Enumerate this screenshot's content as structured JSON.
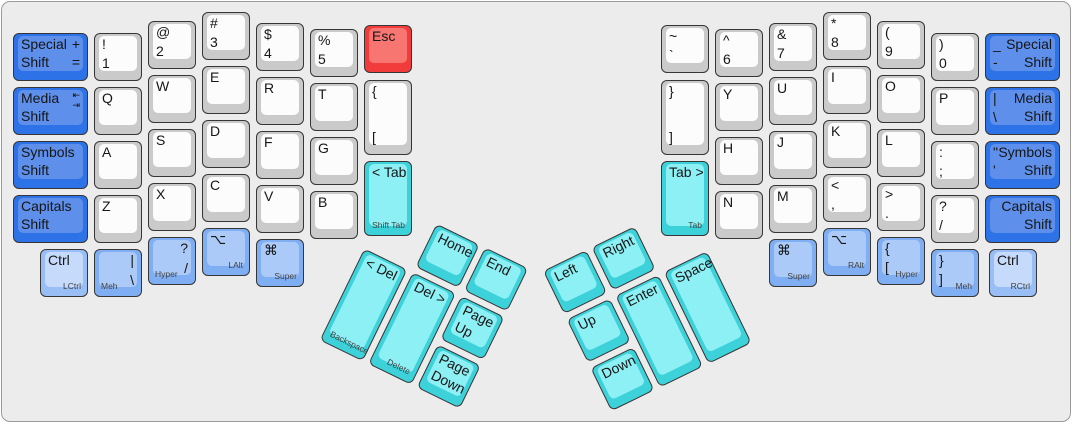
{
  "panel": {
    "background": "#ececec",
    "border": "#9b9b9b"
  },
  "colors": {
    "white": {
      "base": "#cacaca",
      "top": "#fcfcfc"
    },
    "blue": {
      "base": "#2d72e6",
      "top": "#5d8feb"
    },
    "lblue": {
      "base": "#80aef3",
      "top": "#abcaf8"
    },
    "ctrl": {
      "base": "#98bef5",
      "top": "#c6dbfb"
    },
    "cyan": {
      "base": "#3dd1d9",
      "top": "#8df0f4"
    },
    "red": {
      "base": "#f23c3c",
      "top": "#f87672"
    }
  },
  "clusters": {
    "left": {
      "x": 386,
      "y": 198,
      "angle": 26,
      "group": "lt"
    },
    "right": {
      "x": 541,
      "y": 269,
      "angle": -26,
      "group": "rt"
    }
  },
  "keys": [
    {
      "n": "special-shift-left",
      "x": 11,
      "y": 31,
      "w": 75,
      "c": "blue",
      "tl": [
        "Special",
        "Shift"
      ],
      "tr": [
        "+",
        "="
      ]
    },
    {
      "n": "media-shift-left",
      "x": 11,
      "y": 85,
      "w": 75,
      "c": "blue",
      "tl": [
        "Media",
        "Shift"
      ],
      "tr": [
        "⇤",
        "⇥"
      ],
      "tiny": true
    },
    {
      "n": "symbols-shift-left",
      "x": 11,
      "y": 139,
      "w": 75,
      "c": "blue",
      "tl": [
        "Symbols",
        "Shift"
      ]
    },
    {
      "n": "capitals-shift-left",
      "x": 11,
      "y": 193,
      "w": 75,
      "c": "blue",
      "tl": [
        "Capitals",
        "Shift"
      ]
    },
    {
      "n": "key-1",
      "x": 92,
      "y": 31,
      "tl": [
        "!"
      ],
      "bl": [
        "1"
      ]
    },
    {
      "n": "key-q",
      "x": 92,
      "y": 85,
      "tl": [
        "Q"
      ]
    },
    {
      "n": "key-a",
      "x": 92,
      "y": 139,
      "tl": [
        "A"
      ]
    },
    {
      "n": "key-z",
      "x": 92,
      "y": 193,
      "tl": [
        "Z"
      ]
    },
    {
      "n": "meh-left",
      "x": 92,
      "y": 247,
      "c": "lblue",
      "tr": [
        "|"
      ],
      "br": [
        "\\"
      ],
      "subl": "Meh"
    },
    {
      "n": "key-2",
      "x": 146,
      "y": 19,
      "tl": [
        "@"
      ],
      "bl": [
        "2"
      ]
    },
    {
      "n": "key-w",
      "x": 146,
      "y": 73,
      "tl": [
        "W"
      ]
    },
    {
      "n": "key-s",
      "x": 146,
      "y": 127,
      "tl": [
        "S"
      ]
    },
    {
      "n": "key-x",
      "x": 146,
      "y": 181,
      "tl": [
        "X"
      ]
    },
    {
      "n": "hyper-left",
      "x": 146,
      "y": 235,
      "c": "lblue",
      "tr": [
        "?"
      ],
      "br": [
        "/"
      ],
      "subl": "Hyper"
    },
    {
      "n": "key-3",
      "x": 200,
      "y": 10,
      "tl": [
        "#"
      ],
      "bl": [
        "3"
      ]
    },
    {
      "n": "key-e",
      "x": 200,
      "y": 64,
      "tl": [
        "E"
      ]
    },
    {
      "n": "key-d",
      "x": 200,
      "y": 118,
      "tl": [
        "D"
      ]
    },
    {
      "n": "key-c",
      "x": 200,
      "y": 172,
      "tl": [
        "C"
      ]
    },
    {
      "n": "lalt",
      "x": 200,
      "y": 226,
      "c": "lblue",
      "tl": [
        "⌥"
      ],
      "sub": "LAlt"
    },
    {
      "n": "key-4",
      "x": 254,
      "y": 21,
      "tl": [
        "$"
      ],
      "bl": [
        "4"
      ]
    },
    {
      "n": "key-r",
      "x": 254,
      "y": 75,
      "tl": [
        "R"
      ]
    },
    {
      "n": "key-f",
      "x": 254,
      "y": 129,
      "tl": [
        "F"
      ]
    },
    {
      "n": "key-v",
      "x": 254,
      "y": 183,
      "tl": [
        "V"
      ]
    },
    {
      "n": "super-left",
      "x": 254,
      "y": 237,
      "c": "lblue",
      "tl": [
        "⌘"
      ],
      "sub": "Super"
    },
    {
      "n": "key-5",
      "x": 308,
      "y": 27,
      "tl": [
        "%"
      ],
      "bl": [
        "5"
      ]
    },
    {
      "n": "key-t",
      "x": 308,
      "y": 81,
      "tl": [
        "T"
      ]
    },
    {
      "n": "key-g",
      "x": 308,
      "y": 135,
      "tl": [
        "G"
      ]
    },
    {
      "n": "key-b",
      "x": 308,
      "y": 189,
      "tl": [
        "B"
      ]
    },
    {
      "n": "esc-key",
      "x": 362,
      "y": 23,
      "c": "red",
      "tl": [
        "Esc"
      ]
    },
    {
      "n": "lbrace-key",
      "x": 362,
      "y": 78,
      "h": 75,
      "tl": [
        "{"
      ],
      "bl": [
        "["
      ]
    },
    {
      "n": "tab-left",
      "x": 362,
      "y": 159,
      "h": 75,
      "c": "cyan",
      "tl": [
        "< Tab"
      ],
      "sub": "Shift Tab"
    },
    {
      "n": "ctrl-left",
      "x": 38,
      "y": 247,
      "c": "ctrl",
      "tl": [
        "Ctrl"
      ],
      "sub": "LCtrl"
    },
    {
      "n": "key-tilde",
      "x": 659,
      "y": 23,
      "tl": [
        "~"
      ],
      "bl": [
        "`"
      ]
    },
    {
      "n": "rbrace-key",
      "x": 659,
      "y": 78,
      "h": 75,
      "tl": [
        "}"
      ],
      "bl": [
        "]"
      ]
    },
    {
      "n": "tab-right",
      "x": 659,
      "y": 159,
      "h": 75,
      "c": "cyan",
      "tl": [
        "Tab >"
      ],
      "sub": "Tab"
    },
    {
      "n": "key-6",
      "x": 713,
      "y": 27,
      "tl": [
        "^"
      ],
      "bl": [
        "6"
      ]
    },
    {
      "n": "key-y",
      "x": 713,
      "y": 81,
      "tl": [
        "Y"
      ]
    },
    {
      "n": "key-h",
      "x": 713,
      "y": 135,
      "tl": [
        "H"
      ]
    },
    {
      "n": "key-n",
      "x": 713,
      "y": 189,
      "tl": [
        "N"
      ]
    },
    {
      "n": "key-7",
      "x": 767,
      "y": 21,
      "tl": [
        "&"
      ],
      "bl": [
        "7"
      ]
    },
    {
      "n": "key-u",
      "x": 767,
      "y": 75,
      "tl": [
        "U"
      ]
    },
    {
      "n": "key-j",
      "x": 767,
      "y": 129,
      "tl": [
        "J"
      ]
    },
    {
      "n": "key-m",
      "x": 767,
      "y": 183,
      "tl": [
        "M"
      ]
    },
    {
      "n": "super-right",
      "x": 767,
      "y": 237,
      "c": "lblue",
      "tl": [
        "⌘"
      ],
      "sub": "Super"
    },
    {
      "n": "key-8",
      "x": 821,
      "y": 10,
      "tl": [
        "*"
      ],
      "bl": [
        "8"
      ]
    },
    {
      "n": "key-i",
      "x": 821,
      "y": 64,
      "tl": [
        "I"
      ]
    },
    {
      "n": "key-k",
      "x": 821,
      "y": 118,
      "tl": [
        "K"
      ]
    },
    {
      "n": "key-comma",
      "x": 821,
      "y": 172,
      "tl": [
        "<"
      ],
      "bl": [
        ","
      ]
    },
    {
      "n": "ralt",
      "x": 821,
      "y": 226,
      "c": "lblue",
      "tl": [
        "⌥"
      ],
      "sub": "RAlt"
    },
    {
      "n": "key-9",
      "x": 875,
      "y": 19,
      "tl": [
        "("
      ],
      "bl": [
        "9"
      ]
    },
    {
      "n": "key-o",
      "x": 875,
      "y": 73,
      "tl": [
        "O"
      ]
    },
    {
      "n": "key-l",
      "x": 875,
      "y": 127,
      "tl": [
        "L"
      ]
    },
    {
      "n": "key-period",
      "x": 875,
      "y": 181,
      "tl": [
        ">"
      ],
      "bl": [
        "."
      ]
    },
    {
      "n": "hyper-right",
      "x": 875,
      "y": 235,
      "c": "lblue",
      "tl": [
        "{"
      ],
      "bl": [
        "["
      ],
      "sub": "Hyper"
    },
    {
      "n": "key-0",
      "x": 929,
      "y": 31,
      "tl": [
        ")"
      ],
      "bl": [
        "0"
      ]
    },
    {
      "n": "key-p",
      "x": 929,
      "y": 85,
      "tl": [
        "P"
      ]
    },
    {
      "n": "key-semicolon",
      "x": 929,
      "y": 139,
      "tl": [
        ":"
      ],
      "bl": [
        ";"
      ]
    },
    {
      "n": "key-slash",
      "x": 929,
      "y": 193,
      "tl": [
        "?"
      ],
      "bl": [
        "/"
      ]
    },
    {
      "n": "meh-right",
      "x": 929,
      "y": 247,
      "c": "lblue",
      "tl": [
        "}"
      ],
      "bl": [
        "]"
      ],
      "sub": "Meh"
    },
    {
      "n": "special-shift-right",
      "x": 983,
      "y": 31,
      "w": 75,
      "c": "blue",
      "tr": [
        "Special",
        "Shift"
      ],
      "tl": [
        "_",
        "-"
      ]
    },
    {
      "n": "media-shift-right",
      "x": 983,
      "y": 85,
      "w": 75,
      "c": "blue",
      "tr": [
        "Media",
        "Shift"
      ],
      "tl": [
        "|"
      ],
      "bl": [
        "\\"
      ]
    },
    {
      "n": "symbols-shift-right",
      "x": 983,
      "y": 139,
      "w": 75,
      "c": "blue",
      "tr": [
        "Symbols",
        "Shift"
      ],
      "tl": [
        "\"",
        "'"
      ]
    },
    {
      "n": "capitals-shift-right",
      "x": 983,
      "y": 193,
      "w": 75,
      "c": "blue",
      "tr": [
        "Capitals",
        "Shift"
      ]
    },
    {
      "n": "ctrl-right",
      "x": 987,
      "y": 247,
      "c": "ctrl",
      "tl": [
        "Ctrl"
      ],
      "sub": "RCtrl"
    },
    {
      "n": "home-key",
      "g": "lt",
      "x": 54,
      "y": 0,
      "c": "cyan",
      "tl": [
        "Home"
      ]
    },
    {
      "n": "end-key",
      "g": "lt",
      "x": 108,
      "y": 0,
      "c": "cyan",
      "tl": [
        "End"
      ]
    },
    {
      "n": "backspace-key",
      "g": "lt",
      "x": 0,
      "y": 54,
      "h": 102,
      "c": "cyan",
      "tl": [
        "< Del"
      ],
      "subl": "Backspace"
    },
    {
      "n": "delete-key",
      "g": "lt",
      "x": 54,
      "y": 54,
      "h": 102,
      "c": "cyan",
      "tl": [
        "Del >"
      ],
      "sub": "Delete"
    },
    {
      "n": "page-up-key",
      "g": "lt",
      "x": 108,
      "y": 54,
      "c": "cyan",
      "tl": [
        "Page",
        "Up"
      ]
    },
    {
      "n": "page-down-key",
      "g": "lt",
      "x": 108,
      "y": 108,
      "c": "cyan",
      "tl": [
        "Page",
        "Down"
      ]
    },
    {
      "n": "arrow-left-key",
      "g": "rt",
      "x": 0,
      "y": 0,
      "c": "cyan",
      "tl": [
        "Left"
      ]
    },
    {
      "n": "arrow-right-key",
      "g": "rt",
      "x": 54,
      "y": 0,
      "c": "cyan",
      "tl": [
        "Right"
      ]
    },
    {
      "n": "arrow-up-key",
      "g": "rt",
      "x": 0,
      "y": 54,
      "c": "cyan",
      "tl": [
        "Up"
      ]
    },
    {
      "n": "arrow-down-key",
      "g": "rt",
      "x": 0,
      "y": 108,
      "c": "cyan",
      "tl": [
        "Down"
      ]
    },
    {
      "n": "enter-key",
      "g": "rt",
      "x": 54,
      "y": 54,
      "h": 102,
      "c": "cyan",
      "tl": [
        "Enter"
      ]
    },
    {
      "n": "space-key",
      "g": "rt",
      "x": 108,
      "y": 54,
      "h": 102,
      "c": "cyan",
      "tl": [
        "Space"
      ]
    }
  ]
}
